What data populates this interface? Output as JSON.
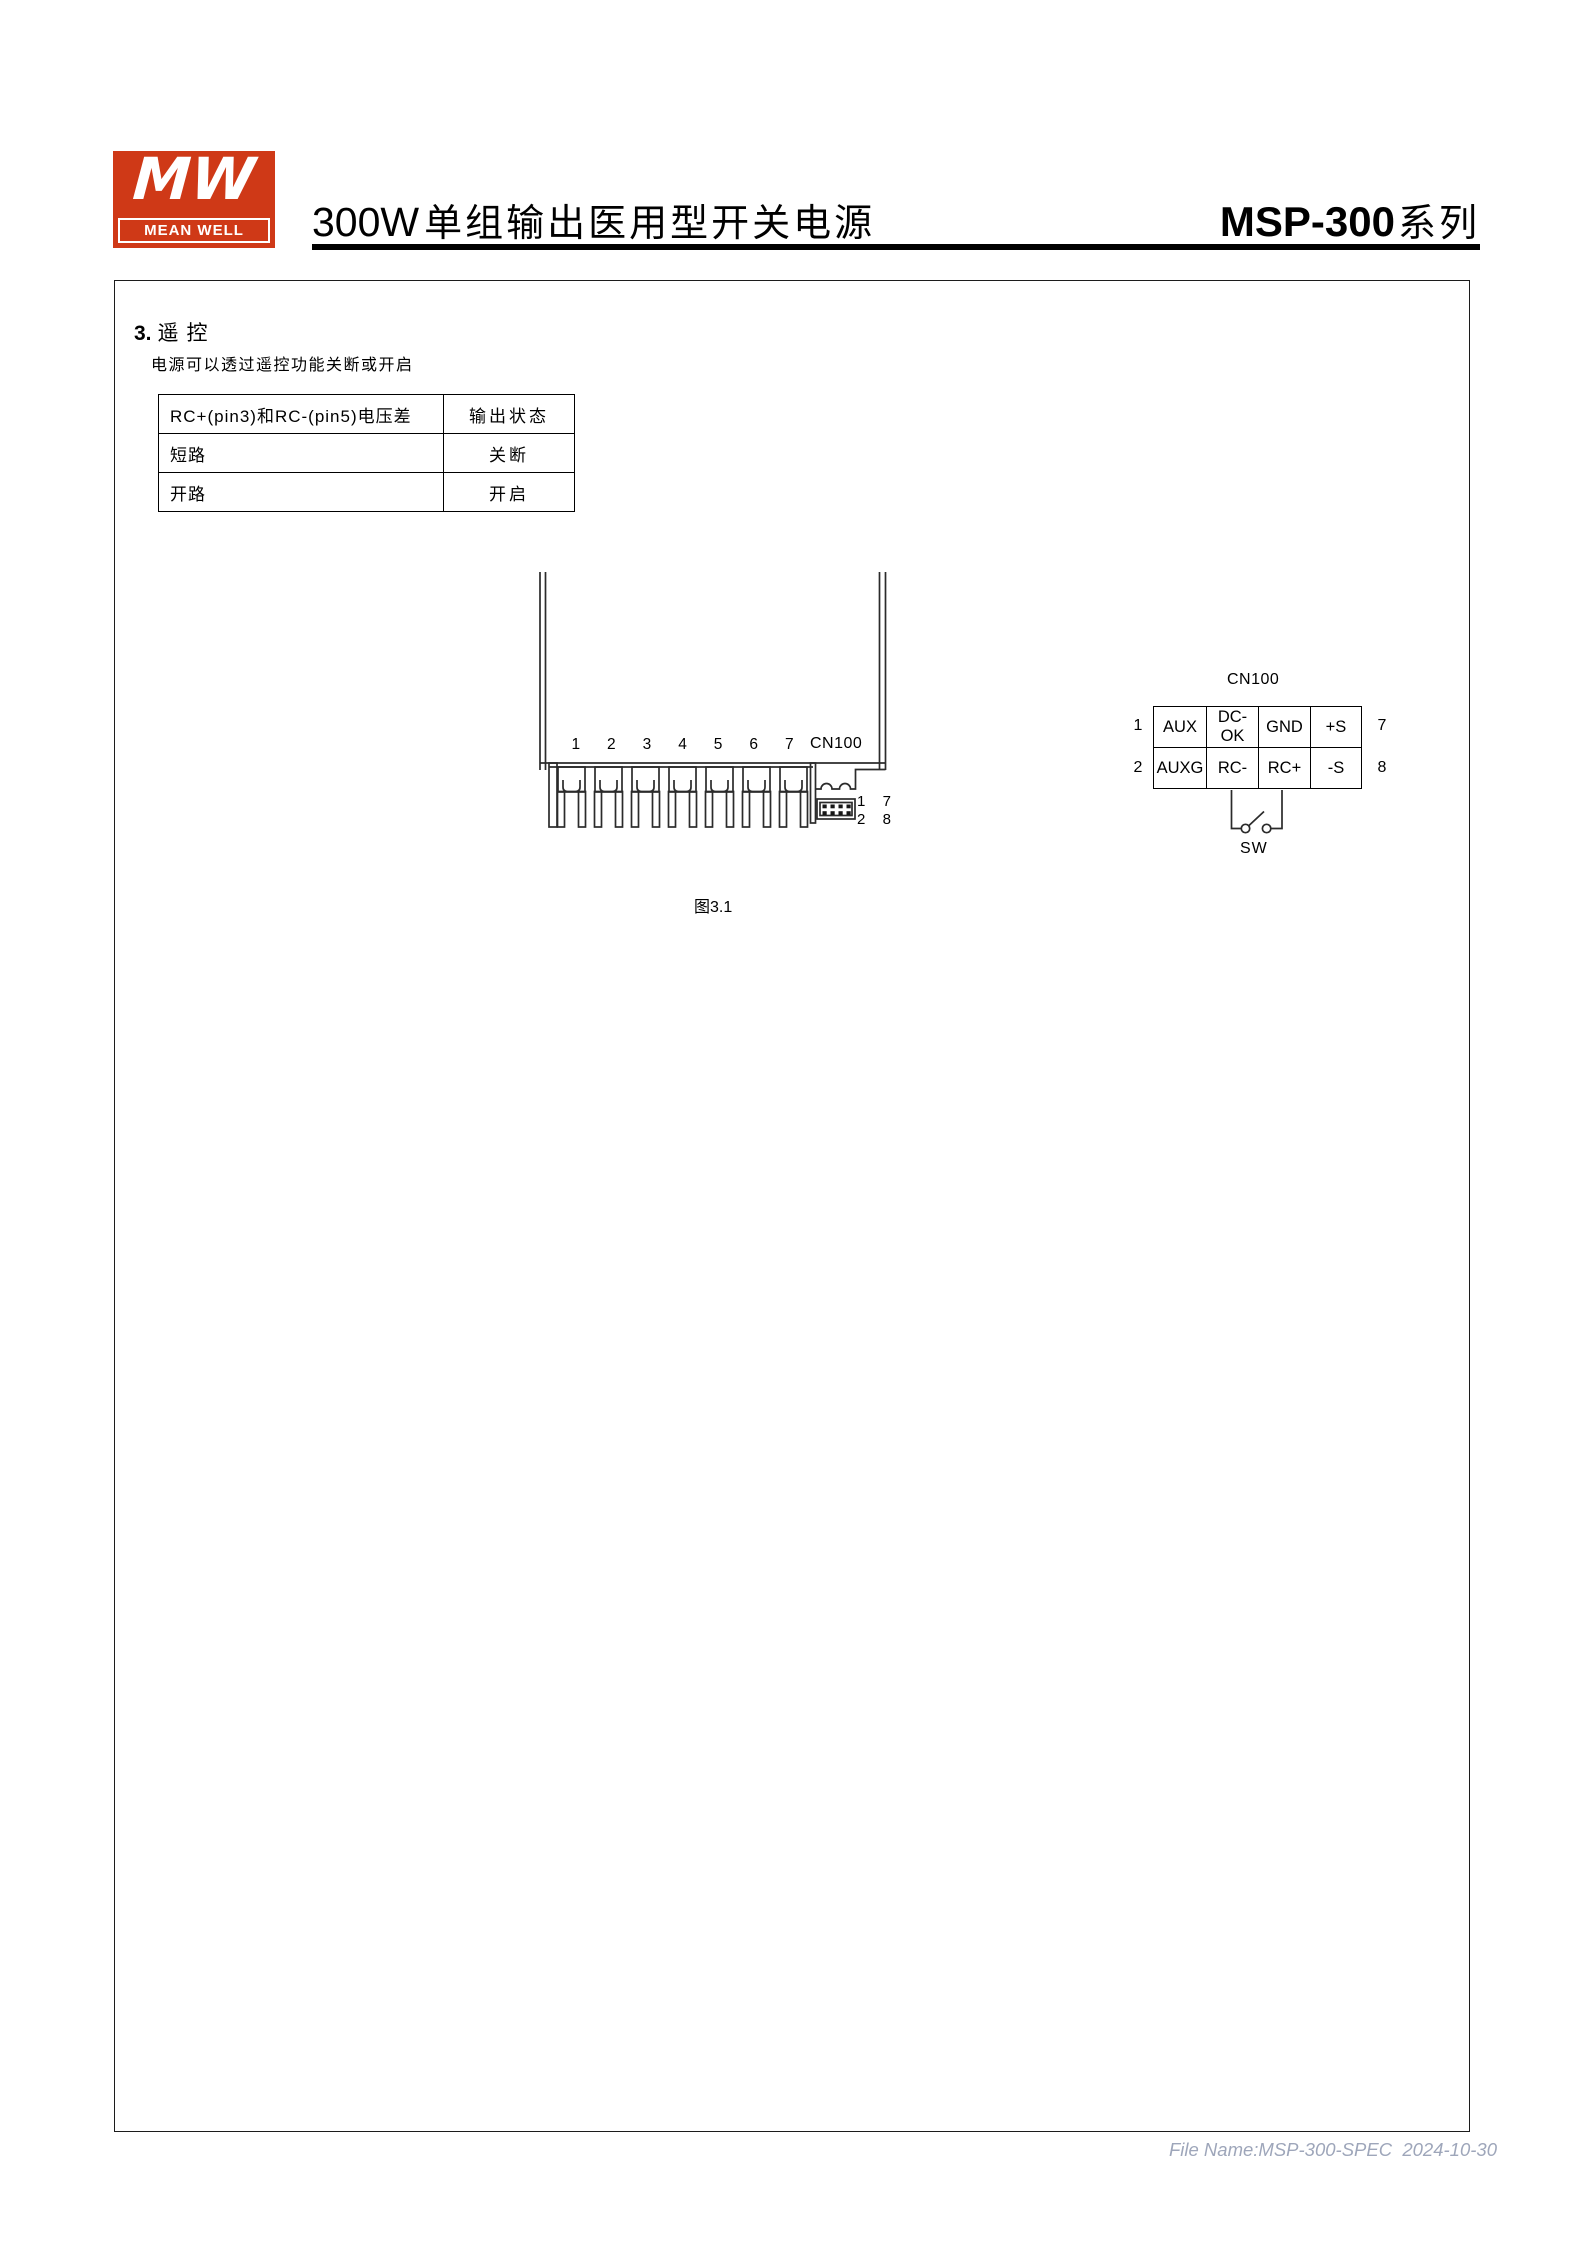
{
  "header": {
    "logo": {
      "monogram": "MW",
      "brand": "MEAN WELL",
      "accent_color": "#cf3917"
    },
    "title_prefix": "300W",
    "title_zh": "单组输出医用型开关电源",
    "series_model": "MSP-300",
    "series_suffix": "系列"
  },
  "section": {
    "number": "3.",
    "title": "遥控",
    "description": "电源可以透过遥控功能关断或开启"
  },
  "rc_table": {
    "header": [
      "RC+(pin3)和RC-(pin5)电压差",
      "输出状态"
    ],
    "rows": [
      [
        "短路",
        "关断"
      ],
      [
        "开路",
        "开启"
      ]
    ]
  },
  "figure": {
    "caption": "图3.1",
    "terminal_numbers": [
      "1",
      "2",
      "3",
      "4",
      "5",
      "6",
      "7"
    ],
    "connector_label": "CN100",
    "connector_pins_top": [
      "1",
      "7"
    ],
    "connector_pins_bottom": [
      "2",
      "8"
    ]
  },
  "cn100_pinout": {
    "title": "CN100",
    "left_pins": [
      "1",
      "2"
    ],
    "right_pins": [
      "7",
      "8"
    ],
    "row1": [
      "AUX",
      "DC-OK",
      "GND",
      "+S"
    ],
    "row2": [
      "AUXG",
      "RC-",
      "RC+",
      "-S"
    ],
    "switch_label": "SW"
  },
  "footer": {
    "file_info": "File Name:MSP-300-SPEC  2024-10-30",
    "text_color": "#9ea6ba"
  }
}
